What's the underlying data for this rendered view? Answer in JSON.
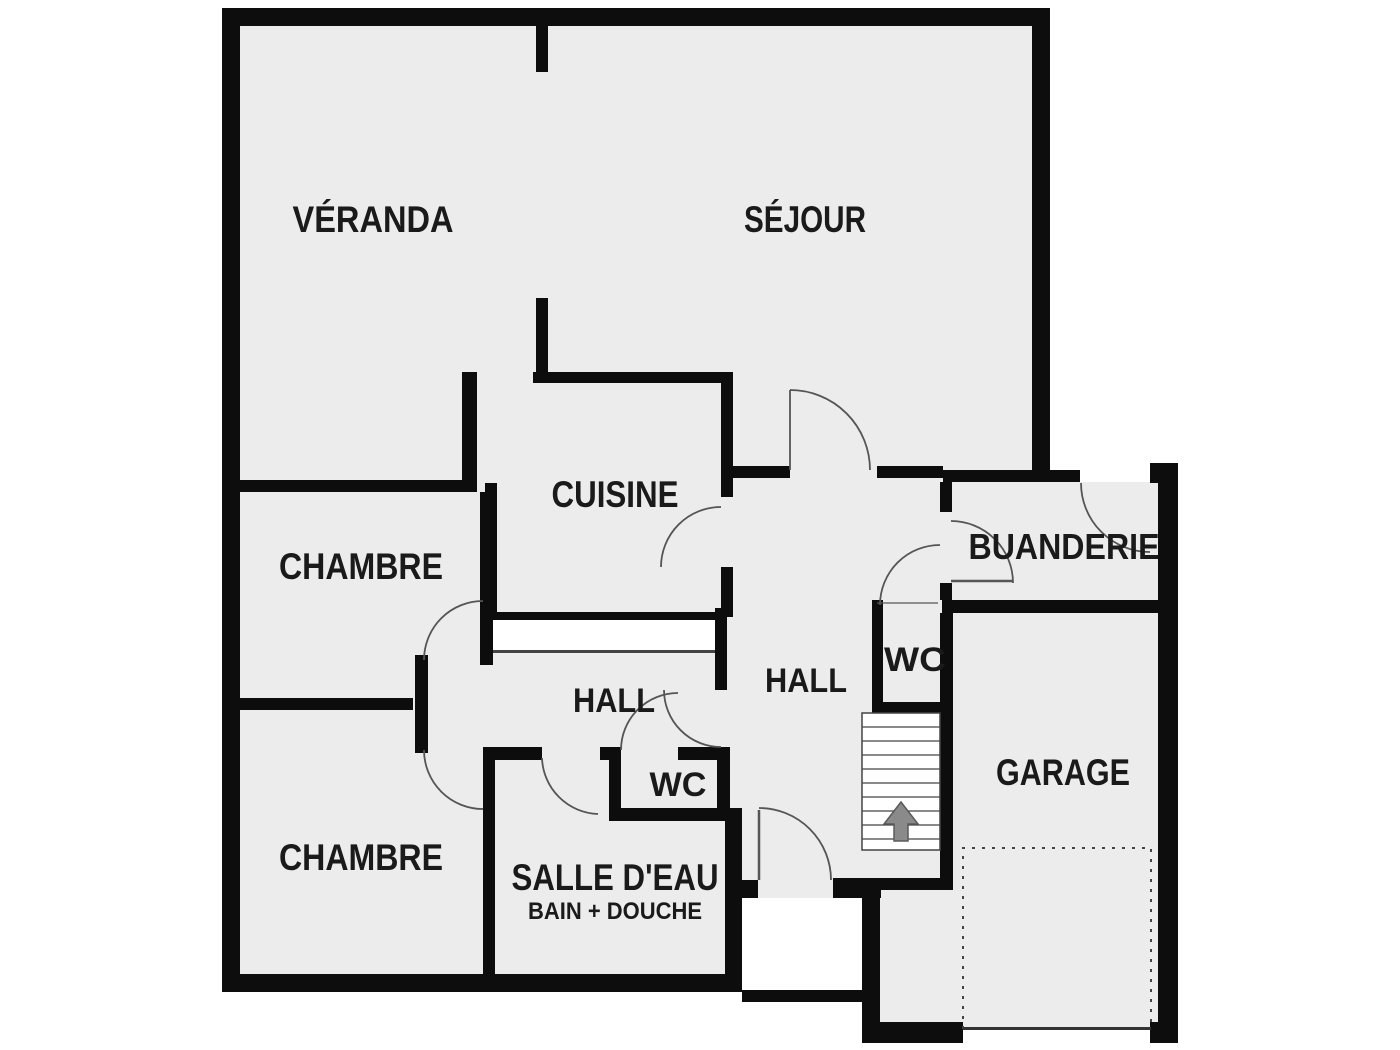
{
  "plan": {
    "type": "floor-plan",
    "language": "fr",
    "colors": {
      "floor": "#ececec",
      "wall": "#0d0d0d",
      "outside": "#ffffff",
      "door_line": "#555555",
      "text": "#1a1a1a",
      "arrow_fill": "#8a8a8a",
      "arrow_edge": "#5a5a5a"
    },
    "rooms": {
      "veranda": {
        "label": "VÉRANDA"
      },
      "sejour": {
        "label": "SÉJOUR"
      },
      "cuisine": {
        "label": "CUISINE"
      },
      "chambre_haut": {
        "label": "CHAMBRE"
      },
      "chambre_bas": {
        "label": "CHAMBRE"
      },
      "buanderie": {
        "label": "BUANDERIE"
      },
      "wc_droite": {
        "label": "WC"
      },
      "wc_centre": {
        "label": "WC"
      },
      "hall_droite": {
        "label": "HALL"
      },
      "hall_centre": {
        "label": "HALL"
      },
      "garage": {
        "label": "GARAGE"
      },
      "salle_deau": {
        "label": "SALLE D'EAU",
        "sublabel": "BAIN + DOUCHE"
      }
    },
    "stairs": {
      "arrow_direction": "up",
      "step_count": 10
    }
  }
}
